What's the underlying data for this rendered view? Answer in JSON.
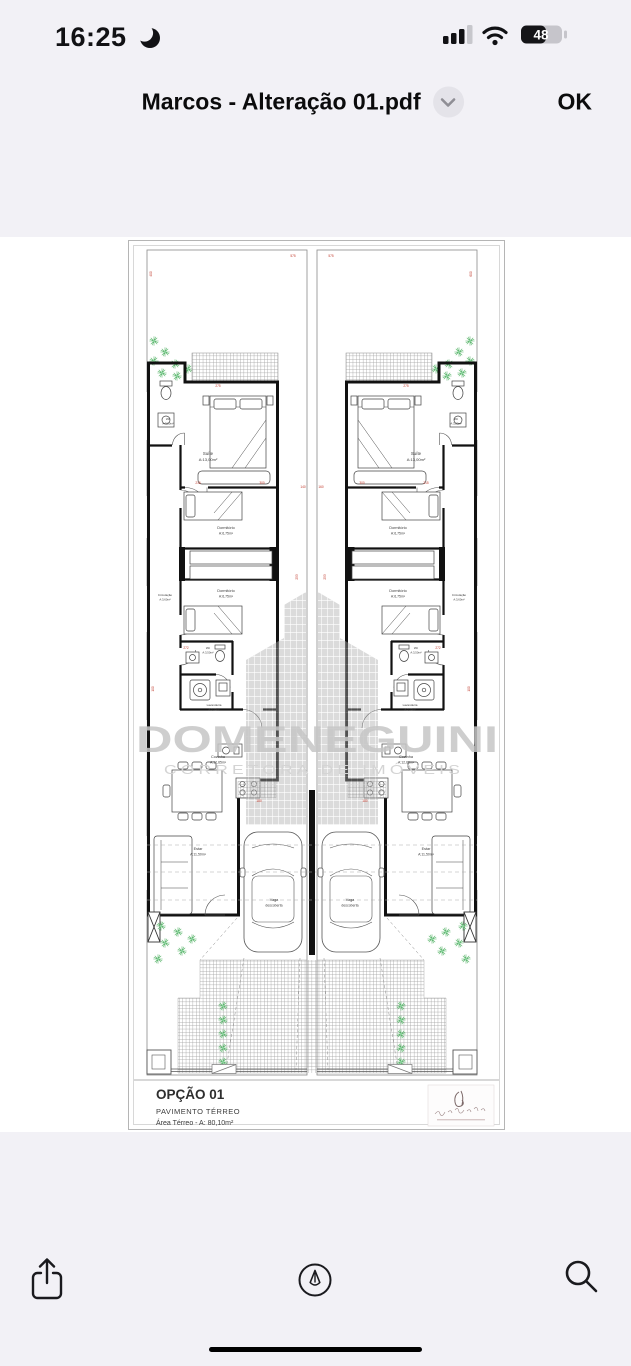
{
  "status_bar": {
    "time": "16:25",
    "battery_percent": "48",
    "icons": [
      "moon-icon",
      "cellular-signal-icon",
      "wifi-icon",
      "battery-icon"
    ]
  },
  "header": {
    "title": "Marcos - Alteração 01.pdf",
    "chevron_icon": "chevron-down-icon",
    "ok_label": "OK"
  },
  "floorplan": {
    "rooms": {
      "wc_top": {
        "name": "Wc",
        "area": "A:3,20m²"
      },
      "suite": {
        "name": "Suíte",
        "area": "A:13,00m²"
      },
      "dorm1": {
        "name": "Dormitório",
        "area": "A:6,75m²"
      },
      "dorm2": {
        "name": "Dormitório",
        "area": "A:6,75m²"
      },
      "circulacao": {
        "name": "Circulação",
        "area": "A:3,60m²"
      },
      "wc_mid": {
        "name": "Wc",
        "area": "A:3,50m²"
      },
      "lavanderia": {
        "name": "Lavanderia",
        "area": "A:3,35m²"
      },
      "cozinha": {
        "name": "Cozinha",
        "area": "A:12,65m²"
      },
      "estar": {
        "name": "Estar",
        "area": "A:11,50m²"
      },
      "vaga": {
        "name": "Vaga",
        "area": "descoberta"
      }
    },
    "dimensions": [
      "400",
      "575",
      "600",
      "275",
      "215",
      "300",
      "253",
      "272",
      "140",
      "160",
      "100",
      "180"
    ],
    "watermark": {
      "name": "DOMENEGUINI",
      "tagline": "CORRETORA DE IMÓVEIS"
    },
    "title_block": {
      "option": "OPÇÃO 01",
      "level": "PAVIMENTO TÉRREO",
      "area": "Área Térreo - A: 80,10m²"
    },
    "colors": {
      "dimension_red": "#c0392b",
      "plant_green": "#4fb061",
      "watermark_gray": "#c6c6c6",
      "wall_black": "#111111"
    }
  },
  "toolbar": {
    "icons": [
      "share-icon",
      "markup-icon",
      "search-icon"
    ]
  }
}
